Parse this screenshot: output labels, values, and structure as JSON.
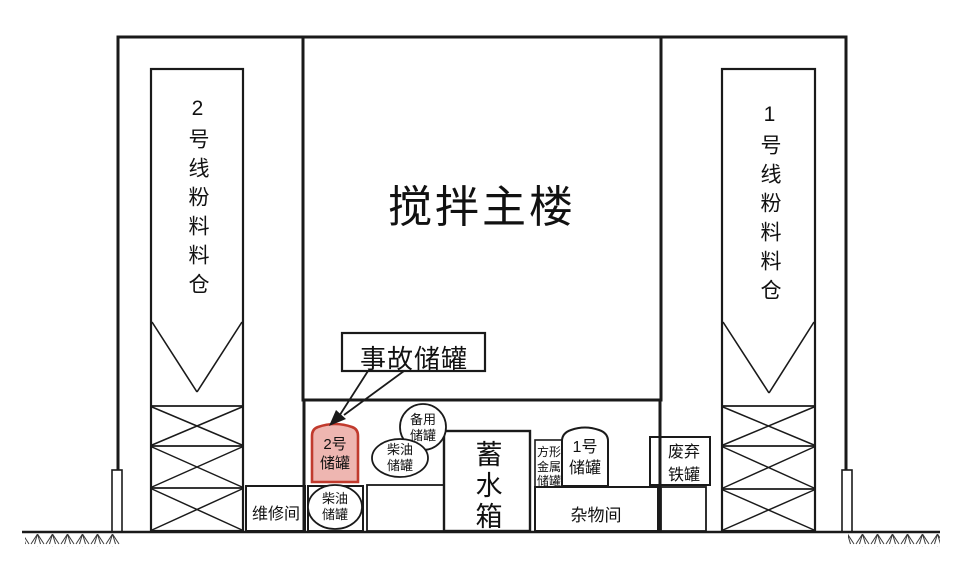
{
  "diagram": {
    "main_building": "搅拌主楼",
    "silo_line_2": "2号线粉料料仓",
    "silo_line_1": "1号线粉料料仓",
    "callout": "事故储罐",
    "tank_no2": "2号\n储罐",
    "backup_tank": "备用\n储罐",
    "diesel_tank_upper": "柴油\n储罐",
    "diesel_tank_lower": "柴油\n储罐",
    "maintenance_room": "维修间",
    "water_tank": "蓄水箱",
    "square_metal_tank": "方形\n金属\n储罐",
    "tank_no1": "1号\n储罐",
    "sundries_room": "杂物间",
    "scrap_iron_tank": "废弃\n铁罐"
  },
  "colors": {
    "line": "#1a1a1a",
    "highlight_border": "#c13a2d",
    "highlight_fill": "#eeb6b1"
  }
}
